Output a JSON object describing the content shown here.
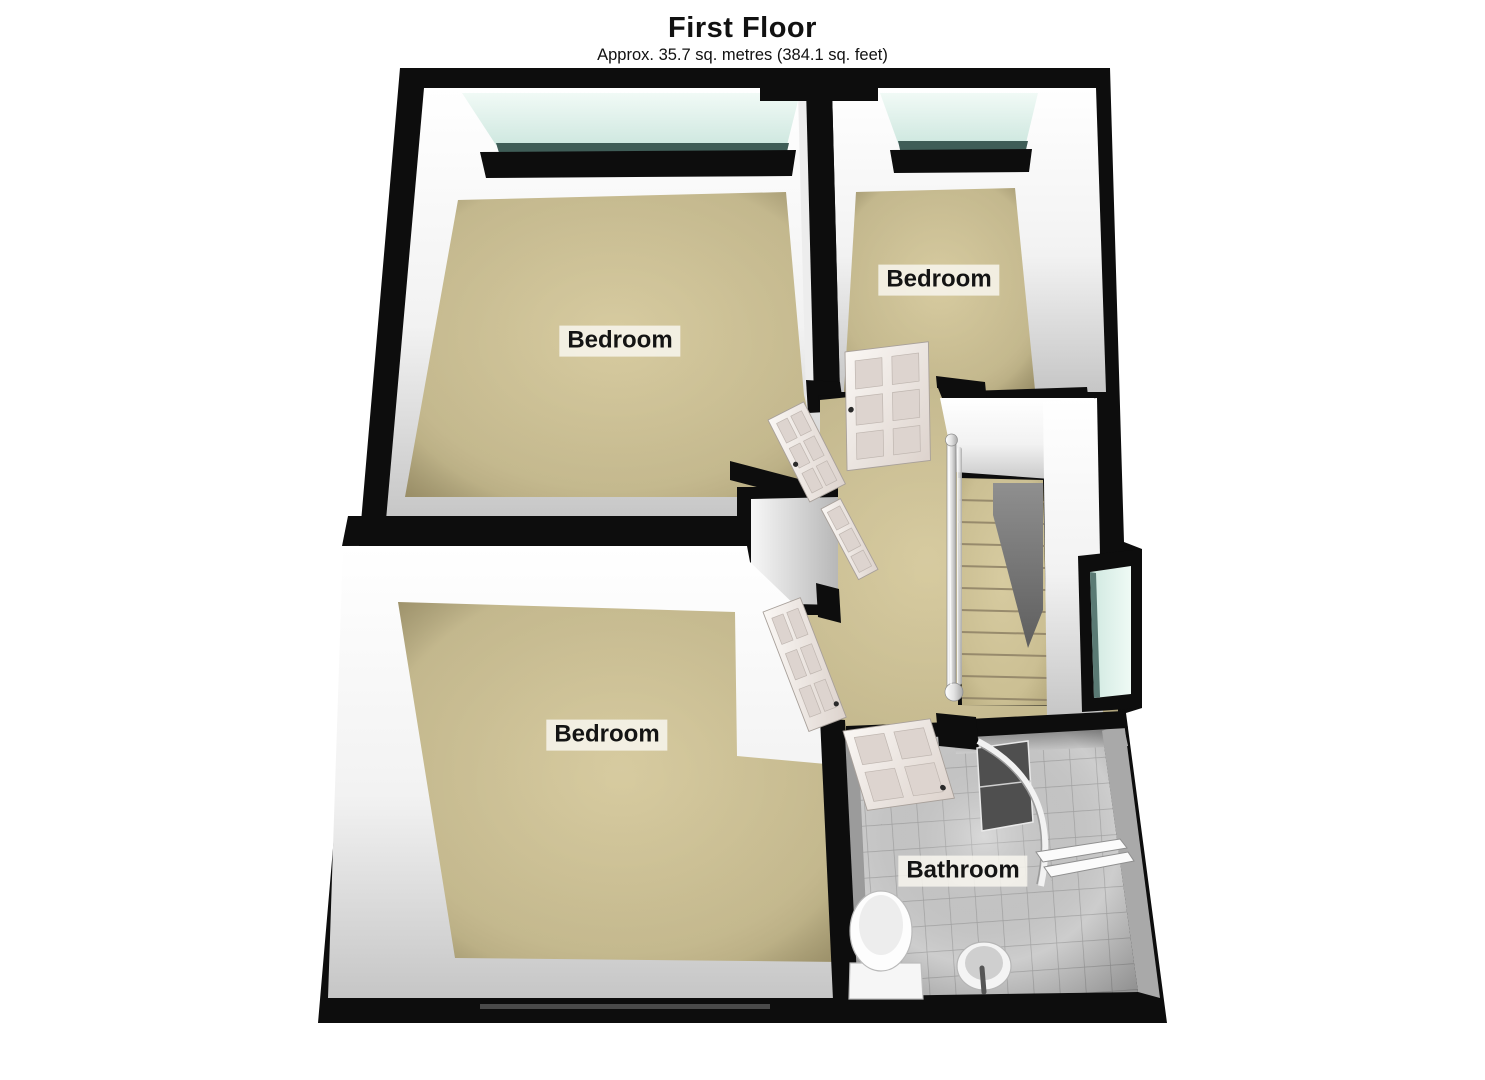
{
  "header": {
    "title": "First Floor",
    "subtitle": "Approx. 35.7 sq. metres (384.1 sq. feet)"
  },
  "rooms": [
    {
      "id": "bedroom-top-left",
      "label": "Bedroom"
    },
    {
      "id": "bedroom-top-right",
      "label": "Bedroom"
    },
    {
      "id": "bedroom-bottom-left",
      "label": "Bedroom"
    },
    {
      "id": "bathroom",
      "label": "Bathroom"
    }
  ],
  "fixtures": [
    "staircase-icon",
    "banister-icon",
    "toilet-icon",
    "sink-icon",
    "shower-icon",
    "towel-rail-icon",
    "window-icon",
    "door-icon"
  ],
  "colors": {
    "wall": "#0d0d0d",
    "carpet": "#cbbf93",
    "glass": "#ddf1ea",
    "tile": "#cdcdcd",
    "door": "#f0eae6"
  }
}
